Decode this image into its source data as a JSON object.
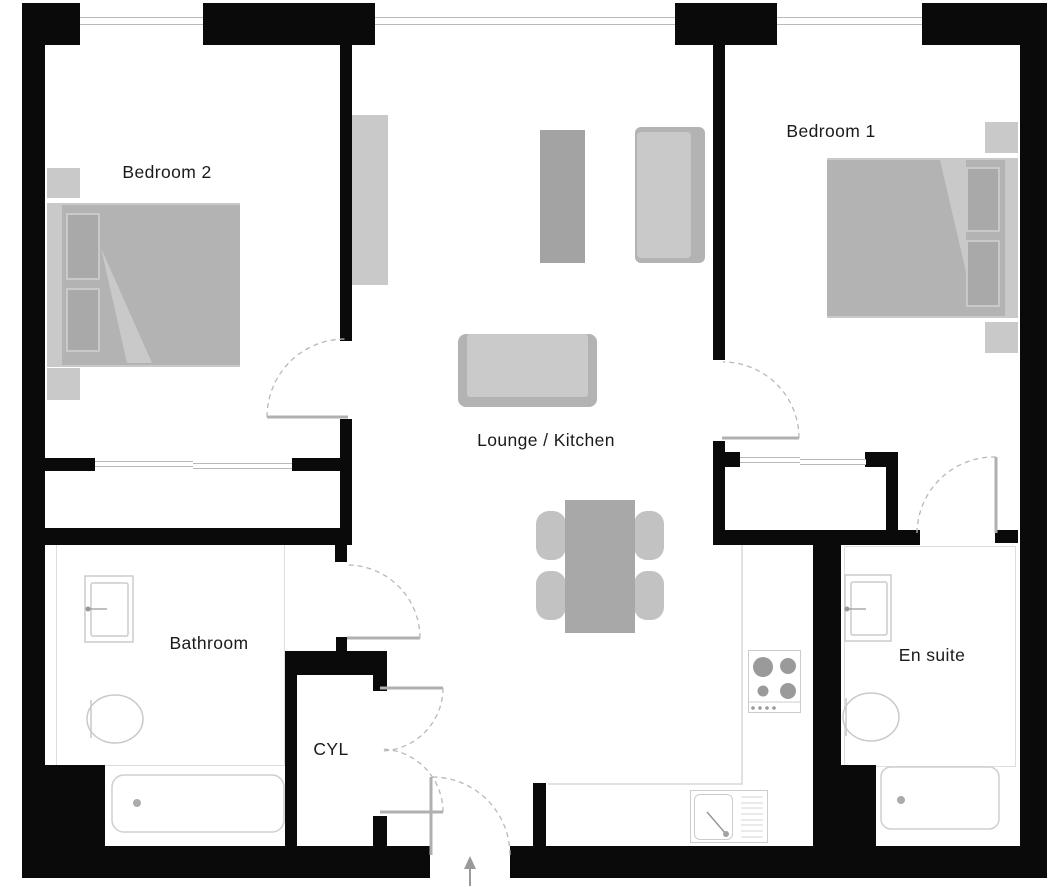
{
  "diagram_type": "floor-plan",
  "rooms": {
    "bedroom2": {
      "label": "Bedroom 2",
      "furniture": [
        "double-bed",
        "pillow",
        "pillow",
        "bedside-table",
        "bedside-table",
        "wardrobe"
      ]
    },
    "bedroom1": {
      "label": "Bedroom 1",
      "furniture": [
        "double-bed",
        "pillow",
        "pillow",
        "bedside-table",
        "bedside-table"
      ]
    },
    "lounge_kitchen": {
      "label": "Lounge / Kitchen",
      "furniture": [
        "sofa",
        "side-sofa",
        "tv-unit",
        "dining-table",
        "chair",
        "chair",
        "chair",
        "chair",
        "kitchen-counter",
        "hob",
        "kitchen-sink"
      ]
    },
    "bathroom": {
      "label": "Bathroom",
      "fixtures": [
        "basin",
        "toilet",
        "bathtub"
      ]
    },
    "cylinder_cupboard": {
      "label": "CYL"
    },
    "ensuite": {
      "label": "En suite",
      "fixtures": [
        "basin",
        "toilet",
        "bathtub"
      ]
    }
  },
  "doors": [
    "bedroom2-door",
    "bedroom1-door",
    "bathroom-door",
    "cyl-double-door-upper",
    "cyl-double-door-lower",
    "entrance-door",
    "ensuite-door"
  ],
  "windows_count": 7,
  "entrance": {
    "indicator": "entry-arrow-up"
  },
  "colors": {
    "wall": "#0a0a0a",
    "furniture_light": "#c9c9c9",
    "furniture_mid": "#b3b3b3",
    "furniture_dark": "#a3a3a3",
    "fixture_outline": "#cfcfcf",
    "floor_outline": "#dedede",
    "window_line": "#b9b9b9",
    "door_swing_dash": "#b8b8b8",
    "label_text": "#1a1a1a"
  }
}
